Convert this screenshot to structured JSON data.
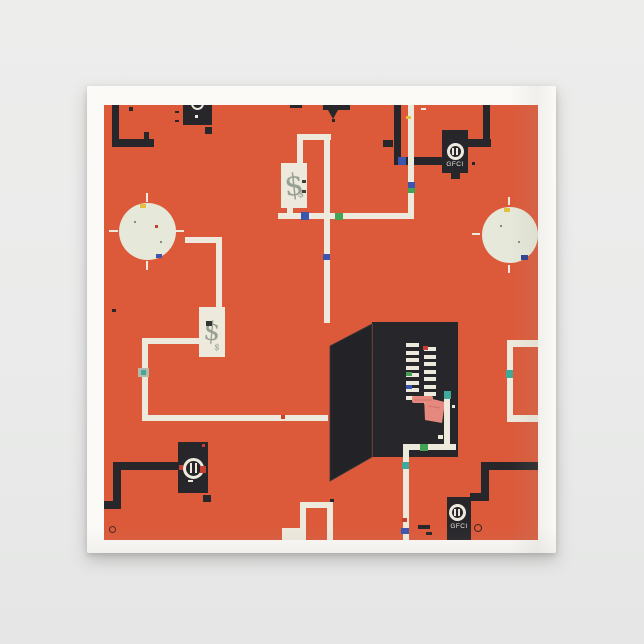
{
  "scene": {
    "description": "product photo of a folded white paper napkin on gray background",
    "colors": {
      "page_background": "#eaebea",
      "napkin_white": "#fbfaf7",
      "print_orange": "#dc5a3a",
      "ink_black": "#27272b",
      "ink_cream": "#ede9dc",
      "circle_cream": "#e6e8d9",
      "meter_glyph": "#96a193",
      "hand_pink": "#e5897e",
      "blue": "#3c55ae",
      "green": "#44a254",
      "teal": "#3fa99c",
      "red": "#c6402f",
      "yellow": "#e2c23c",
      "navy": "#2e3f8f",
      "gray": "#b7b7ae"
    }
  },
  "print_elements": {
    "gfci_outlet_top": {
      "label": "GFCI"
    },
    "gfci_outlet_bottom": {
      "label": "GFCI"
    },
    "electric_meter_top": {
      "symbol": "$"
    },
    "electric_meter_mid": {
      "symbol": "$"
    },
    "breaker_panel": {
      "columns": 2,
      "breakers_per_column": 8
    },
    "light_fixtures": 2,
    "duplex_outlets": 2
  }
}
